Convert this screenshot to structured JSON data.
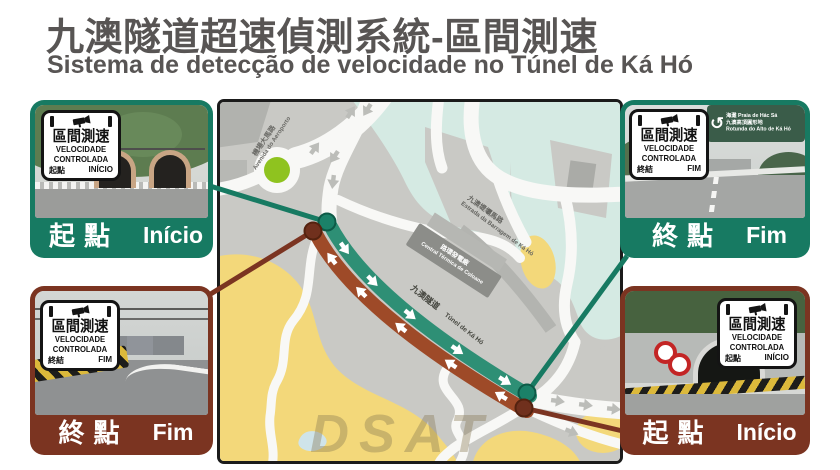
{
  "title": {
    "zh": "九澳隧道超速偵測系統-區間測速",
    "pt": "Sistema de detecção de velocidade no Túnel de Ká Hó"
  },
  "panels": {
    "top_left": {
      "sign": {
        "title": "區間測速",
        "l1": "VELOCIDADE",
        "l2": "CONTROLADA",
        "pzh": "起點",
        "ppt": "INÍCIO"
      },
      "bar": {
        "zh": "起點",
        "pt": "Início"
      }
    },
    "top_right": {
      "sign": {
        "title": "區間測速",
        "l1": "VELOCIDADE",
        "l2": "CONTROLADA",
        "pzh": "終結",
        "ppt": "FIM"
      },
      "bar": {
        "zh": "終點",
        "pt": "Fim"
      },
      "road_sign": {
        "icon": "↺",
        "line1": "海灘 Praia de Hác Sá",
        "line2": "九澳高頂圓形地",
        "line3": "Rotunda do Alto de Ká Hó"
      }
    },
    "bottom_left": {
      "sign": {
        "title": "區間測速",
        "l1": "VELOCIDADE",
        "l2": "CONTROLADA",
        "pzh": "終結",
        "ppt": "FIM"
      },
      "bar": {
        "zh": "終點",
        "pt": "Fim"
      }
    },
    "bottom_right": {
      "sign": {
        "title": "區間測速",
        "l1": "VELOCIDADE",
        "l2": "CONTROLADA",
        "pzh": "起點",
        "ppt": "INÍCIO"
      },
      "bar": {
        "zh": "起點",
        "pt": "Início"
      }
    }
  },
  "map": {
    "street_airport": {
      "zh": "機場大馬路",
      "pt": "Avenida do Aeroporto"
    },
    "street_barragem": {
      "zh": "九澳堤壩馬路",
      "pt": "Estrada da Barragem de Ká Hó"
    },
    "power_plant": {
      "zh": "路環發電廠",
      "pt": "Central Térmica de Coloane"
    },
    "tunnel": {
      "zh": "九澳隧道",
      "pt": "Túnel de Ká Hó"
    },
    "watermark": "DSAT"
  },
  "colors": {
    "frame_green": "#177a62",
    "frame_dark_red": "#7b3421",
    "route_green": "#2e8f75",
    "route_brown": "#9e4a28",
    "map_water": "#d5eae3",
    "map_land": "#c9c9c5",
    "map_sand": "#f3d87a",
    "roundabout_green": "#8fc31f",
    "title_gray": "#585554"
  }
}
